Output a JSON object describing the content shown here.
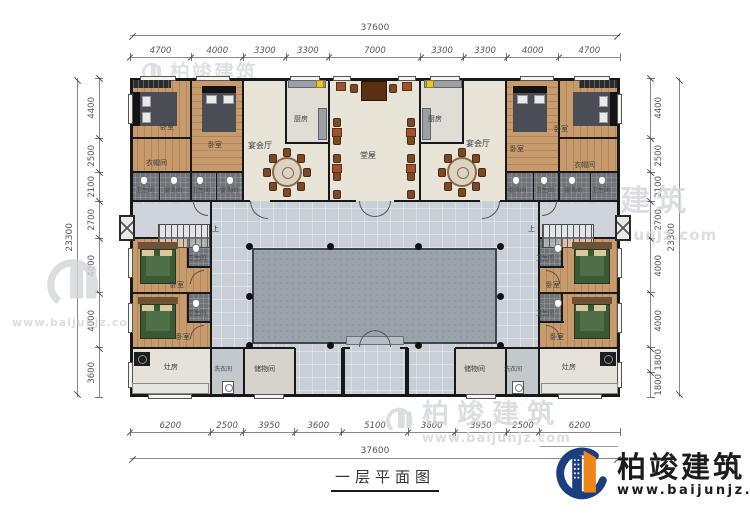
{
  "title": {
    "text": "一层平面图"
  },
  "brand": {
    "name": "柏竣建筑",
    "url": "www.baijunjz.com"
  },
  "watermark": {
    "name": "柏竣建筑",
    "url": "www.baijunjz.com"
  },
  "dims": {
    "top": {
      "total": "37600",
      "segments": [
        "4700",
        "4000",
        "3300",
        "3300",
        "7000",
        "3300",
        "3300",
        "4000",
        "4700"
      ]
    },
    "bottom": {
      "total": "37600",
      "segments": [
        "6200",
        "2500",
        "3950",
        "3600",
        "5100",
        "3600",
        "3950",
        "2500",
        "6200"
      ]
    },
    "left": {
      "total": "23300",
      "segments": [
        "4400",
        "2500",
        "2100",
        "2700",
        "4000",
        "4000",
        "3600"
      ]
    },
    "right": {
      "total": "23300",
      "segments": [
        "4400",
        "2500",
        "2100",
        "2700",
        "4000",
        "4000",
        "1800",
        "1800"
      ]
    }
  },
  "room_labels": {
    "bedroom": "卧室",
    "banquet_hall": "宴会厅",
    "kitchen": "厨房",
    "main_hall": "堂屋",
    "cloakroom": "衣帽间",
    "bathroom": "卫生间",
    "washroom": "盥洗间",
    "stove_room": "灶房",
    "laundry": "洗衣间",
    "storage": "储物间",
    "stairs_up": "上"
  },
  "colors": {
    "wall": "#17181a",
    "corridor": "#c9cfd6",
    "courtyard": "#9aa2ab",
    "wood_floor": "#c79b6b",
    "brand_blue": "#1a3e7e",
    "brand_orange": "#f08519"
  }
}
